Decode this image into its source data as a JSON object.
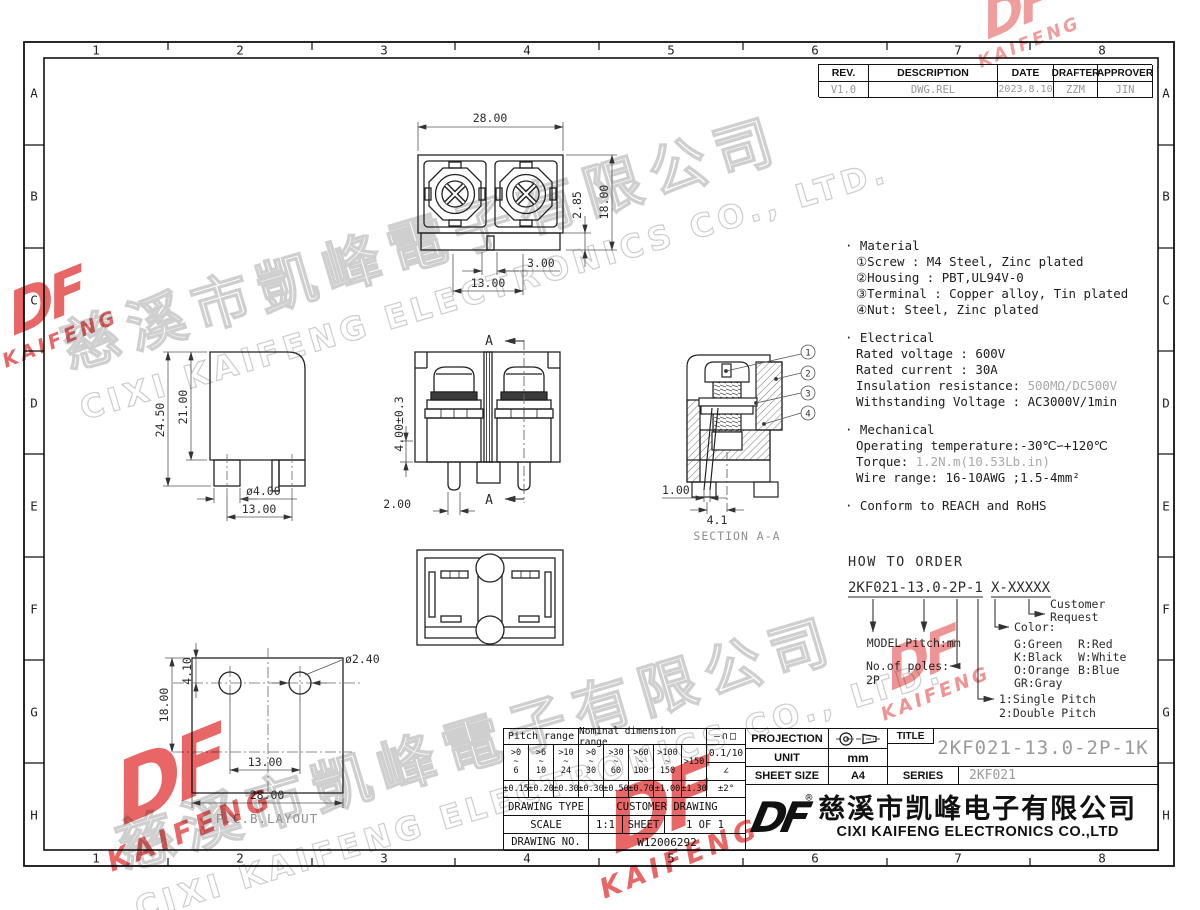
{
  "zones": {
    "cols": [
      "1",
      "2",
      "3",
      "4",
      "5",
      "6",
      "7",
      "8"
    ],
    "rows": [
      "A",
      "B",
      "C",
      "D",
      "E",
      "F",
      "G",
      "H"
    ]
  },
  "rev": {
    "headers": [
      "REV.",
      "DESCRIPTION",
      "DATE",
      "DRAFTER",
      "APPROVER"
    ],
    "row": [
      "V1.0",
      "DWG.REL",
      "2023.8.10",
      "ZZM",
      "JIN"
    ]
  },
  "notes": {
    "material_title": "· Material",
    "m1": "①Screw : M4 Steel, Zinc plated",
    "m2": "②Housing : PBT,UL94V-0",
    "m3": "③Terminal : Copper alloy, Tin plated",
    "m4": "④Nut: Steel, Zinc plated",
    "electrical_title": "· Electrical",
    "e1": "Rated voltage : 600V",
    "e2": "Rated current : 30A",
    "ins_label": "Insulation resistance: ",
    "ins_value": "500MΩ/DC500V",
    "e4": "Withstanding Voltage : AC3000V/1min",
    "mechanical_title": "· Mechanical",
    "op": "Operating temperature:-30℃∽+120℃",
    "torque_label": "Torque: ",
    "torque_value": "1.2N.m(10.53Lb.in)",
    "wire": "Wire range: 16-10AWG ;1.5-4mm²",
    "conform": "· Conform to REACH and RoHS"
  },
  "order": {
    "title": "HOW TO ORDER",
    "code_main": "2KF021-13.0-2P-1",
    "code_suffix": "X-XXXXX",
    "model": "MODEL",
    "pitch": "Pitch:mm",
    "poles_label": "No.of poles:",
    "poles_value": "2P",
    "single": "1:Single Pitch",
    "double": "2:Double Pitch",
    "color_label": "Color:",
    "c1": "G:Green",
    "c2": "K:Black",
    "c3": "O:Orange",
    "c4": "GR:Gray",
    "c5": "R:Red",
    "c6": "W:White",
    "c7": "B:Blue",
    "customer": "Customer",
    "request": "Request"
  },
  "dims": {
    "top": {
      "w": "28.00",
      "h": "18.00",
      "step": "2.85",
      "notch": "3.00",
      "pitch": "13.00"
    },
    "side": {
      "total": "24.50",
      "body": "21.00",
      "pin": "ø4.00",
      "pitch": "13.00"
    },
    "front": {
      "open": "4.00±0.3",
      "pin": "2.00",
      "sec": "A"
    },
    "section": {
      "lever": "1.00",
      "offset": "4.1",
      "label": "SECTION A-A",
      "b1": "1",
      "b2": "2",
      "b3": "3",
      "b4": "4"
    },
    "pcb": {
      "h": "18.00",
      "off": "4.10",
      "hole": "ø2.40",
      "pitch": "13.00",
      "w": "28.00",
      "label": "P.C.B.LAYOUT"
    }
  },
  "tol": {
    "pitch_header": "Pitch range",
    "nominal_header": "Nominal dimension range",
    "symbols": "—∩□",
    "r1": ">0\n~\n6",
    "r2": ">6\n~\n10",
    "r3": ">10\n~\n24",
    "r4": ">0\n~\n30",
    "r5": ">30\n~\n60",
    "r6": ">60\n~\n100",
    "r7": ">100\n~\n150",
    "r8": ">150",
    "flat_tol": "0.1/10",
    "angle_sym": "∠",
    "t1": "±0.15",
    "t2": "±0.20",
    "t3": "±0.30",
    "t4": "±0.30",
    "t5": "±0.50",
    "t6": "±0.70",
    "t7": "±1.00",
    "t8": "±1.30",
    "t9": "±2°",
    "type_label": "DRAWING TYPE",
    "type_value": "CUSTOMER DRAWING",
    "scale_label": "SCALE",
    "scale_value": "1:1",
    "sheet_label": "SHEET",
    "sheet_value": "1 OF 1",
    "no_label": "DRAWING NO.",
    "no_value": "W12006292"
  },
  "tb": {
    "projection_label": "PROJECTION",
    "unit_label": "UNIT",
    "unit_value": "mm",
    "size_label": "SHEET SIZE",
    "size_value": "A4",
    "title_label": "TITLE",
    "title_value": "2KF021-13.0-2P-1K",
    "series_label": "SERIES",
    "series_value": "2KF021",
    "logo": "DF",
    "reg": "®",
    "company_cn": "慈溪市凯峰电子有限公司",
    "company_en": "CIXI KAIFENG ELECTRONICS CO.,LTD"
  },
  "wm": {
    "cn": "慈溪市凱峰電子有限公司",
    "en": "CIXI KAIFENG ELECTRONICS CO., LTD.",
    "logo_df": "DF",
    "logo_kaifeng": "KAIFENG"
  }
}
